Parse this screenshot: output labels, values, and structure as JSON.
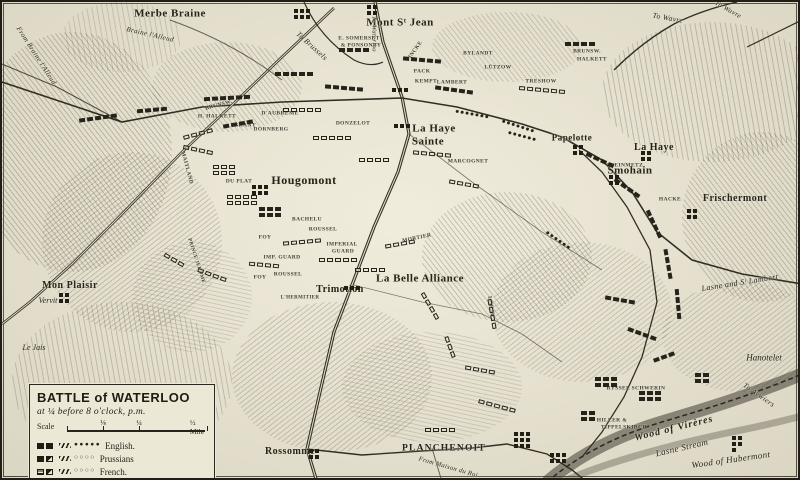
{
  "colors": {
    "paper": "#e9e4d2",
    "ink": "#26231b",
    "frame": "#221e15"
  },
  "title_box": {
    "title": "BATTLE of WATERLOO",
    "subtitle": "at ¼ before 8 o'clock, p.m.",
    "scale_word": "Scale",
    "scale_ticks": [
      "⅛",
      "¼",
      "½ Mile"
    ],
    "legend": [
      {
        "name": "English.",
        "symbol": "english-infantry-cavalry-skirmishers"
      },
      {
        "name": "Prussians",
        "symbol": "prussian-infantry-cavalry-skirmishers"
      },
      {
        "name": "French.",
        "symbol": "french-infantry-cavalry-skirmishers"
      }
    ]
  },
  "labels": [
    {
      "t": "Merbe Braine",
      "x": 168,
      "y": 12,
      "k": "town",
      "fs": 11
    },
    {
      "t": "Mont Sᵗ Jean",
      "x": 398,
      "y": 21,
      "k": "town",
      "fs": 11
    },
    {
      "t": "La Haye",
      "x": 432,
      "y": 127,
      "k": "town",
      "fs": 11
    },
    {
      "t": "Sainte",
      "x": 426,
      "y": 140,
      "k": "town",
      "fs": 11
    },
    {
      "t": "Hougomont",
      "x": 302,
      "y": 178,
      "k": "town",
      "fs": 12
    },
    {
      "t": "La Belle Alliance",
      "x": 418,
      "y": 277,
      "k": "town",
      "fs": 11
    },
    {
      "t": "Trimotion",
      "x": 338,
      "y": 288,
      "k": "town",
      "fs": 10
    },
    {
      "t": "Mon Plaisir",
      "x": 68,
      "y": 284,
      "k": "town",
      "fs": 10
    },
    {
      "t": "Vervit",
      "x": 46,
      "y": 299,
      "k": "ham",
      "fs": 8
    },
    {
      "t": "Le Jais",
      "x": 32,
      "y": 346,
      "k": "ham",
      "fs": 8
    },
    {
      "t": "Rossomme",
      "x": 288,
      "y": 450,
      "k": "town",
      "fs": 10
    },
    {
      "t": "PLANCHENOIT",
      "x": 442,
      "y": 447,
      "k": "cap",
      "fs": 9.5
    },
    {
      "t": "Papelotte",
      "x": 570,
      "y": 136,
      "k": "town",
      "fs": 9
    },
    {
      "t": "La Haye",
      "x": 652,
      "y": 146,
      "k": "town",
      "fs": 10
    },
    {
      "t": "Smohain",
      "x": 628,
      "y": 169,
      "k": "town",
      "fs": 11
    },
    {
      "t": "Frischermont",
      "x": 733,
      "y": 197,
      "k": "town",
      "fs": 10
    },
    {
      "t": "Hanotelet",
      "x": 762,
      "y": 356,
      "k": "ham",
      "fs": 9
    },
    {
      "t": "From Braine l'Alleud",
      "x": 34,
      "y": 54,
      "k": "road",
      "fs": 7,
      "r": 57
    },
    {
      "t": "Braine l'Alleud",
      "x": 148,
      "y": 33,
      "k": "road",
      "fs": 7,
      "r": 13
    },
    {
      "t": "To Brussels",
      "x": 310,
      "y": 44,
      "k": "road",
      "fs": 7.5,
      "r": 42
    },
    {
      "t": "To Waterloo",
      "x": 371,
      "y": 32,
      "k": "road",
      "fs": 6.5,
      "r": 90
    },
    {
      "t": "To Wavre",
      "x": 666,
      "y": 16,
      "k": "road",
      "fs": 7.5,
      "r": 10
    },
    {
      "t": "To Wavre",
      "x": 726,
      "y": 8,
      "k": "road",
      "fs": 7,
      "r": 30
    },
    {
      "t": "Lasne and Sᵗ Lambert",
      "x": 738,
      "y": 281,
      "k": "road",
      "fs": 8,
      "r": -9
    },
    {
      "t": "To Aywiers",
      "x": 757,
      "y": 393,
      "k": "road",
      "fs": 7.5,
      "r": 35
    },
    {
      "t": "From Maison du Roi",
      "x": 446,
      "y": 466,
      "k": "road",
      "fs": 6.5,
      "r": 16
    },
    {
      "t": "Wood of Virères",
      "x": 672,
      "y": 427,
      "k": "wood",
      "fs": 10,
      "r": -14
    },
    {
      "t": "Lasne Stream",
      "x": 680,
      "y": 446,
      "k": "road",
      "fs": 9,
      "r": -13
    },
    {
      "t": "Wood of Hubermont",
      "x": 729,
      "y": 458,
      "k": "road",
      "fs": 9,
      "r": -8
    },
    {
      "t": "E. SOMERSET",
      "x": 357,
      "y": 37,
      "k": "unit",
      "fs": 5.5
    },
    {
      "t": "& PONSONBY",
      "x": 359,
      "y": 44,
      "k": "unit",
      "fs": 5.5
    },
    {
      "t": "BYLANDT",
      "x": 476,
      "y": 52,
      "k": "unit",
      "fs": 5.5
    },
    {
      "t": "LÜTZOW",
      "x": 496,
      "y": 66,
      "k": "unit",
      "fs": 5.5
    },
    {
      "t": "TRESHOW",
      "x": 539,
      "y": 80,
      "k": "unit",
      "fs": 5.5
    },
    {
      "t": "PACK",
      "x": 420,
      "y": 70,
      "k": "unit",
      "fs": 5.5
    },
    {
      "t": "KEMPT",
      "x": 424,
      "y": 80,
      "k": "unit",
      "fs": 5.5
    },
    {
      "t": "LAMBERT",
      "x": 450,
      "y": 81,
      "k": "unit",
      "fs": 5.5
    },
    {
      "t": "VINCKE",
      "x": 413,
      "y": 50,
      "k": "unit",
      "fs": 5.5,
      "r": -55
    },
    {
      "t": "H. HALKETT",
      "x": 215,
      "y": 115,
      "k": "unit",
      "fs": 5.5
    },
    {
      "t": "BRUNSW.",
      "x": 217,
      "y": 104,
      "k": "unit",
      "fs": 5.5,
      "r": -15
    },
    {
      "t": "GRANT",
      "x": 243,
      "y": 124,
      "k": "unit",
      "fs": 5.5
    },
    {
      "t": "DORNBERG",
      "x": 269,
      "y": 128,
      "k": "unit",
      "fs": 5.5
    },
    {
      "t": "D'AUBREMÉ",
      "x": 278,
      "y": 112,
      "k": "unit",
      "fs": 5.5
    },
    {
      "t": "MAITLAND",
      "x": 184,
      "y": 166,
      "k": "unit",
      "fs": 5.5,
      "r": 75
    },
    {
      "t": "BRUNSW.",
      "x": 585,
      "y": 50,
      "k": "unit",
      "fs": 5.5
    },
    {
      "t": "HALKETT",
      "x": 590,
      "y": 58,
      "k": "unit",
      "fs": 5.5
    },
    {
      "t": "DONZELOT",
      "x": 351,
      "y": 122,
      "k": "unit",
      "fs": 5.5
    },
    {
      "t": "MARCOGNET",
      "x": 466,
      "y": 160,
      "k": "unit",
      "fs": 5.5
    },
    {
      "t": "DU PLAT",
      "x": 237,
      "y": 180,
      "k": "unit",
      "fs": 5.5
    },
    {
      "t": "BACHELU",
      "x": 305,
      "y": 218,
      "k": "unit",
      "fs": 5.5
    },
    {
      "t": "ROUSSEL",
      "x": 321,
      "y": 228,
      "k": "unit",
      "fs": 5.5
    },
    {
      "t": "ROUSSEL",
      "x": 286,
      "y": 273,
      "k": "unit",
      "fs": 5.5
    },
    {
      "t": "FOY",
      "x": 263,
      "y": 236,
      "k": "unit",
      "fs": 5.5
    },
    {
      "t": "FOY",
      "x": 258,
      "y": 276,
      "k": "unit",
      "fs": 5.5
    },
    {
      "t": "IMP. GUARD",
      "x": 280,
      "y": 256,
      "k": "unit",
      "fs": 5.5
    },
    {
      "t": "IMPERIAL",
      "x": 340,
      "y": 243,
      "k": "unit",
      "fs": 5.5
    },
    {
      "t": "GUARD",
      "x": 341,
      "y": 250,
      "k": "unit",
      "fs": 5.5
    },
    {
      "t": "MORTIER",
      "x": 415,
      "y": 237,
      "k": "unit",
      "fs": 5.5,
      "r": -12
    },
    {
      "t": "PRINCE JEROME",
      "x": 194,
      "y": 259,
      "k": "unit",
      "fs": 5,
      "r": 72
    },
    {
      "t": "L'HERMITIER",
      "x": 298,
      "y": 296,
      "k": "unit",
      "fs": 5
    },
    {
      "t": "STEINMETZ",
      "x": 623,
      "y": 164,
      "k": "unit",
      "fs": 5.5
    },
    {
      "t": "HACKE",
      "x": 668,
      "y": 198,
      "k": "unit",
      "fs": 5.5
    },
    {
      "t": "LOBAU",
      "x": 488,
      "y": 305,
      "k": "unit",
      "fs": 5.5,
      "r": 82
    },
    {
      "t": "RYSSEL SCHWERIN",
      "x": 634,
      "y": 387,
      "k": "unit",
      "fs": 5.5
    },
    {
      "t": "HILLER &",
      "x": 610,
      "y": 419,
      "k": "unit",
      "fs": 5.5
    },
    {
      "t": "TIPPELSKIRCH",
      "x": 622,
      "y": 426,
      "k": "unit",
      "fs": 5.5
    }
  ],
  "troops": [
    {
      "x": 96,
      "y": 116,
      "n": 5,
      "k": "filled",
      "r": -8
    },
    {
      "x": 150,
      "y": 108,
      "n": 4,
      "k": "filled",
      "r": -5
    },
    {
      "x": 225,
      "y": 96,
      "n": 6,
      "k": "filled",
      "r": -3
    },
    {
      "x": 292,
      "y": 72,
      "n": 5,
      "k": "filled",
      "r": 0
    },
    {
      "x": 342,
      "y": 86,
      "n": 5,
      "k": "filled",
      "r": 5
    },
    {
      "x": 352,
      "y": 48,
      "n": 4,
      "k": "filled",
      "r": 0
    },
    {
      "x": 300,
      "y": 108,
      "n": 5,
      "k": "open",
      "r": 0
    },
    {
      "x": 420,
      "y": 58,
      "n": 5,
      "k": "filled",
      "r": 5
    },
    {
      "x": 452,
      "y": 88,
      "n": 5,
      "k": "filled",
      "r": 8
    },
    {
      "x": 540,
      "y": 88,
      "n": 6,
      "k": "open",
      "r": 5
    },
    {
      "x": 578,
      "y": 42,
      "n": 4,
      "k": "filled",
      "r": 0
    },
    {
      "x": 470,
      "y": 112,
      "n": 7,
      "k": "dots",
      "r": 10
    },
    {
      "x": 516,
      "y": 124,
      "n": 7,
      "k": "dots",
      "r": 18
    },
    {
      "x": 236,
      "y": 122,
      "n": 4,
      "k": "filled",
      "r": -10
    },
    {
      "x": 196,
      "y": 132,
      "n": 4,
      "k": "open",
      "r": -15
    },
    {
      "x": 222,
      "y": 168,
      "n": 6,
      "c": 3,
      "k": "open"
    },
    {
      "x": 240,
      "y": 198,
      "n": 8,
      "c": 4,
      "k": "open"
    },
    {
      "x": 268,
      "y": 210,
      "n": 6,
      "c": 3,
      "k": "filled"
    },
    {
      "x": 196,
      "y": 148,
      "n": 4,
      "k": "open",
      "r": 12
    },
    {
      "x": 330,
      "y": 136,
      "n": 5,
      "k": "open",
      "r": 0
    },
    {
      "x": 372,
      "y": 158,
      "n": 4,
      "k": "open",
      "r": 0
    },
    {
      "x": 430,
      "y": 152,
      "n": 5,
      "k": "open",
      "r": 5
    },
    {
      "x": 462,
      "y": 182,
      "n": 4,
      "k": "open",
      "r": 10
    },
    {
      "x": 300,
      "y": 240,
      "n": 5,
      "k": "open",
      "r": -5
    },
    {
      "x": 336,
      "y": 258,
      "n": 5,
      "k": "open",
      "r": 0
    },
    {
      "x": 262,
      "y": 263,
      "n": 4,
      "k": "open",
      "r": 5
    },
    {
      "x": 210,
      "y": 273,
      "n": 4,
      "k": "open",
      "r": 20
    },
    {
      "x": 172,
      "y": 258,
      "n": 3,
      "k": "open",
      "r": 30
    },
    {
      "x": 368,
      "y": 268,
      "n": 4,
      "k": "open",
      "r": 0
    },
    {
      "x": 398,
      "y": 242,
      "n": 4,
      "k": "open",
      "r": -10
    },
    {
      "x": 428,
      "y": 304,
      "n": 4,
      "k": "open",
      "r": 60
    },
    {
      "x": 448,
      "y": 345,
      "n": 3,
      "k": "open",
      "r": 70
    },
    {
      "x": 490,
      "y": 312,
      "n": 4,
      "k": "open",
      "r": 80
    },
    {
      "x": 478,
      "y": 368,
      "n": 4,
      "k": "open",
      "r": 10
    },
    {
      "x": 495,
      "y": 404,
      "n": 5,
      "k": "open",
      "r": 15
    },
    {
      "x": 438,
      "y": 428,
      "n": 4,
      "k": "open",
      "r": 0
    },
    {
      "x": 520,
      "y": 134,
      "n": 6,
      "k": "dots",
      "r": 15
    },
    {
      "x": 598,
      "y": 158,
      "n": 4,
      "k": "filled",
      "r": 25
    },
    {
      "x": 625,
      "y": 186,
      "n": 4,
      "k": "filled",
      "r": 35
    },
    {
      "x": 652,
      "y": 222,
      "n": 4,
      "k": "filled",
      "r": 65
    },
    {
      "x": 666,
      "y": 262,
      "n": 4,
      "k": "filled",
      "r": 80
    },
    {
      "x": 676,
      "y": 302,
      "n": 4,
      "k": "filled",
      "r": 85
    },
    {
      "x": 618,
      "y": 298,
      "n": 4,
      "k": "filled",
      "r": 10
    },
    {
      "x": 640,
      "y": 332,
      "n": 4,
      "k": "filled",
      "r": 20
    },
    {
      "x": 556,
      "y": 238,
      "n": 6,
      "k": "dots",
      "r": 35
    },
    {
      "x": 604,
      "y": 380,
      "n": 6,
      "c": 3,
      "k": "filled"
    },
    {
      "x": 648,
      "y": 394,
      "n": 6,
      "c": 3,
      "k": "filled"
    },
    {
      "x": 586,
      "y": 414,
      "n": 4,
      "c": 2,
      "k": "filled"
    },
    {
      "x": 700,
      "y": 376,
      "n": 4,
      "c": 2,
      "k": "filled"
    },
    {
      "x": 662,
      "y": 355,
      "n": 3,
      "k": "filled",
      "r": -20
    },
    {
      "x": 300,
      "y": 12,
      "n": 6,
      "c": 3,
      "k": "bldg"
    },
    {
      "x": 370,
      "y": 8,
      "n": 4,
      "c": 2,
      "k": "bldg"
    },
    {
      "x": 398,
      "y": 88,
      "n": 3,
      "k": "bldg"
    },
    {
      "x": 400,
      "y": 124,
      "n": 3,
      "k": "bldg"
    },
    {
      "x": 258,
      "y": 188,
      "n": 6,
      "c": 3,
      "k": "bldg"
    },
    {
      "x": 350,
      "y": 286,
      "n": 3,
      "k": "bldg"
    },
    {
      "x": 312,
      "y": 452,
      "n": 4,
      "c": 2,
      "k": "bldg"
    },
    {
      "x": 520,
      "y": 438,
      "n": 9,
      "c": 3,
      "k": "bldg"
    },
    {
      "x": 556,
      "y": 456,
      "n": 6,
      "c": 3,
      "k": "bldg"
    },
    {
      "x": 576,
      "y": 148,
      "n": 4,
      "c": 2,
      "k": "bldg"
    },
    {
      "x": 644,
      "y": 154,
      "n": 4,
      "c": 2,
      "k": "bldg"
    },
    {
      "x": 612,
      "y": 178,
      "n": 4,
      "c": 2,
      "k": "bldg"
    },
    {
      "x": 690,
      "y": 212,
      "n": 4,
      "c": 2,
      "k": "bldg"
    },
    {
      "x": 735,
      "y": 442,
      "n": 5,
      "c": 2,
      "k": "bldg"
    },
    {
      "x": 62,
      "y": 296,
      "n": 4,
      "c": 2,
      "k": "bldg"
    }
  ]
}
